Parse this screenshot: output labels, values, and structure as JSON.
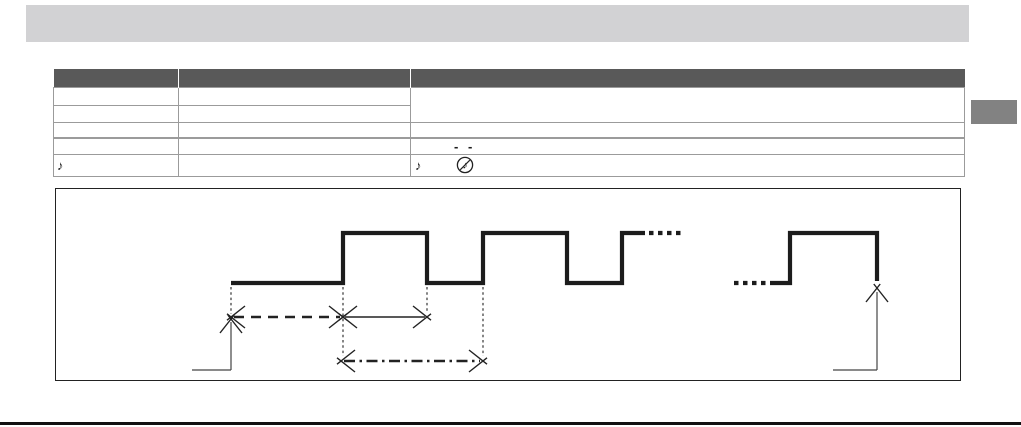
{
  "top_bar": {
    "color": "#d2d2d4",
    "text": ""
  },
  "side_tab": {
    "color": "#828282",
    "text": ""
  },
  "table": {
    "border_color": "#9b9b9b",
    "header_bg": "#595959",
    "columns": [
      "",
      "",
      ""
    ],
    "rows": [
      {
        "col1": "",
        "col2": "",
        "col3_merged": ""
      },
      {
        "col1": "",
        "col2": ""
      },
      {
        "col1": "",
        "col2": "",
        "col3": ""
      },
      {
        "col1": "",
        "col2": "",
        "col3_dashes": "- -"
      },
      {
        "col1_note": "♪",
        "col2": "",
        "col3_note": "♪",
        "col3_icon": "muted-note-icon"
      }
    ]
  },
  "diagram": {
    "box": {
      "x": 55,
      "y": 188,
      "w": 904,
      "h": 191
    },
    "wave_color": "#1c1c1c",
    "thin_color": "#444444",
    "levels": {
      "high_y": 233,
      "low_y": 283
    },
    "waveform_segments": [
      {
        "type": "solid",
        "points": [
          [
            231,
            283
          ],
          [
            343,
            283
          ],
          [
            343,
            233
          ],
          [
            427,
            233
          ],
          [
            427,
            283
          ],
          [
            483,
            283
          ],
          [
            483,
            233
          ],
          [
            567,
            233
          ],
          [
            567,
            283
          ],
          [
            622,
            283
          ],
          [
            622,
            233
          ],
          [
            645,
            233
          ]
        ]
      },
      {
        "type": "dots",
        "y": 233,
        "x1": 649,
        "x2": 684
      },
      {
        "type": "dots",
        "y": 283,
        "x1": 734,
        "x2": 770
      },
      {
        "type": "solid",
        "points": [
          [
            770,
            283
          ],
          [
            790,
            283
          ],
          [
            790,
            233
          ],
          [
            877,
            233
          ],
          [
            877,
            281
          ]
        ]
      }
    ],
    "dotted_verticals": [
      {
        "x": 231,
        "y1": 287,
        "y2": 314
      },
      {
        "x": 343,
        "y1": 287,
        "y2": 356
      },
      {
        "x": 427,
        "y1": 287,
        "y2": 313
      },
      {
        "x": 483,
        "y1": 287,
        "y2": 356
      }
    ],
    "dim_arrows": [
      {
        "style": "dashed",
        "x1": 231,
        "x2": 343,
        "y": 317
      },
      {
        "style": "solid",
        "x1": 343,
        "x2": 427,
        "y": 317
      },
      {
        "style": "dashdot",
        "x1": 341,
        "x2": 483,
        "y": 361
      }
    ],
    "pointer_arrows": [
      {
        "hx1": 192,
        "hx2": 231,
        "hy": 370,
        "vx": 231,
        "vy1": 370,
        "vy2": 322,
        "tip_y": 319
      },
      {
        "hx1": 833,
        "hx2": 877,
        "hy": 370,
        "vx": 877,
        "vy1": 370,
        "vy2": 292,
        "tip_y": 288
      }
    ]
  }
}
